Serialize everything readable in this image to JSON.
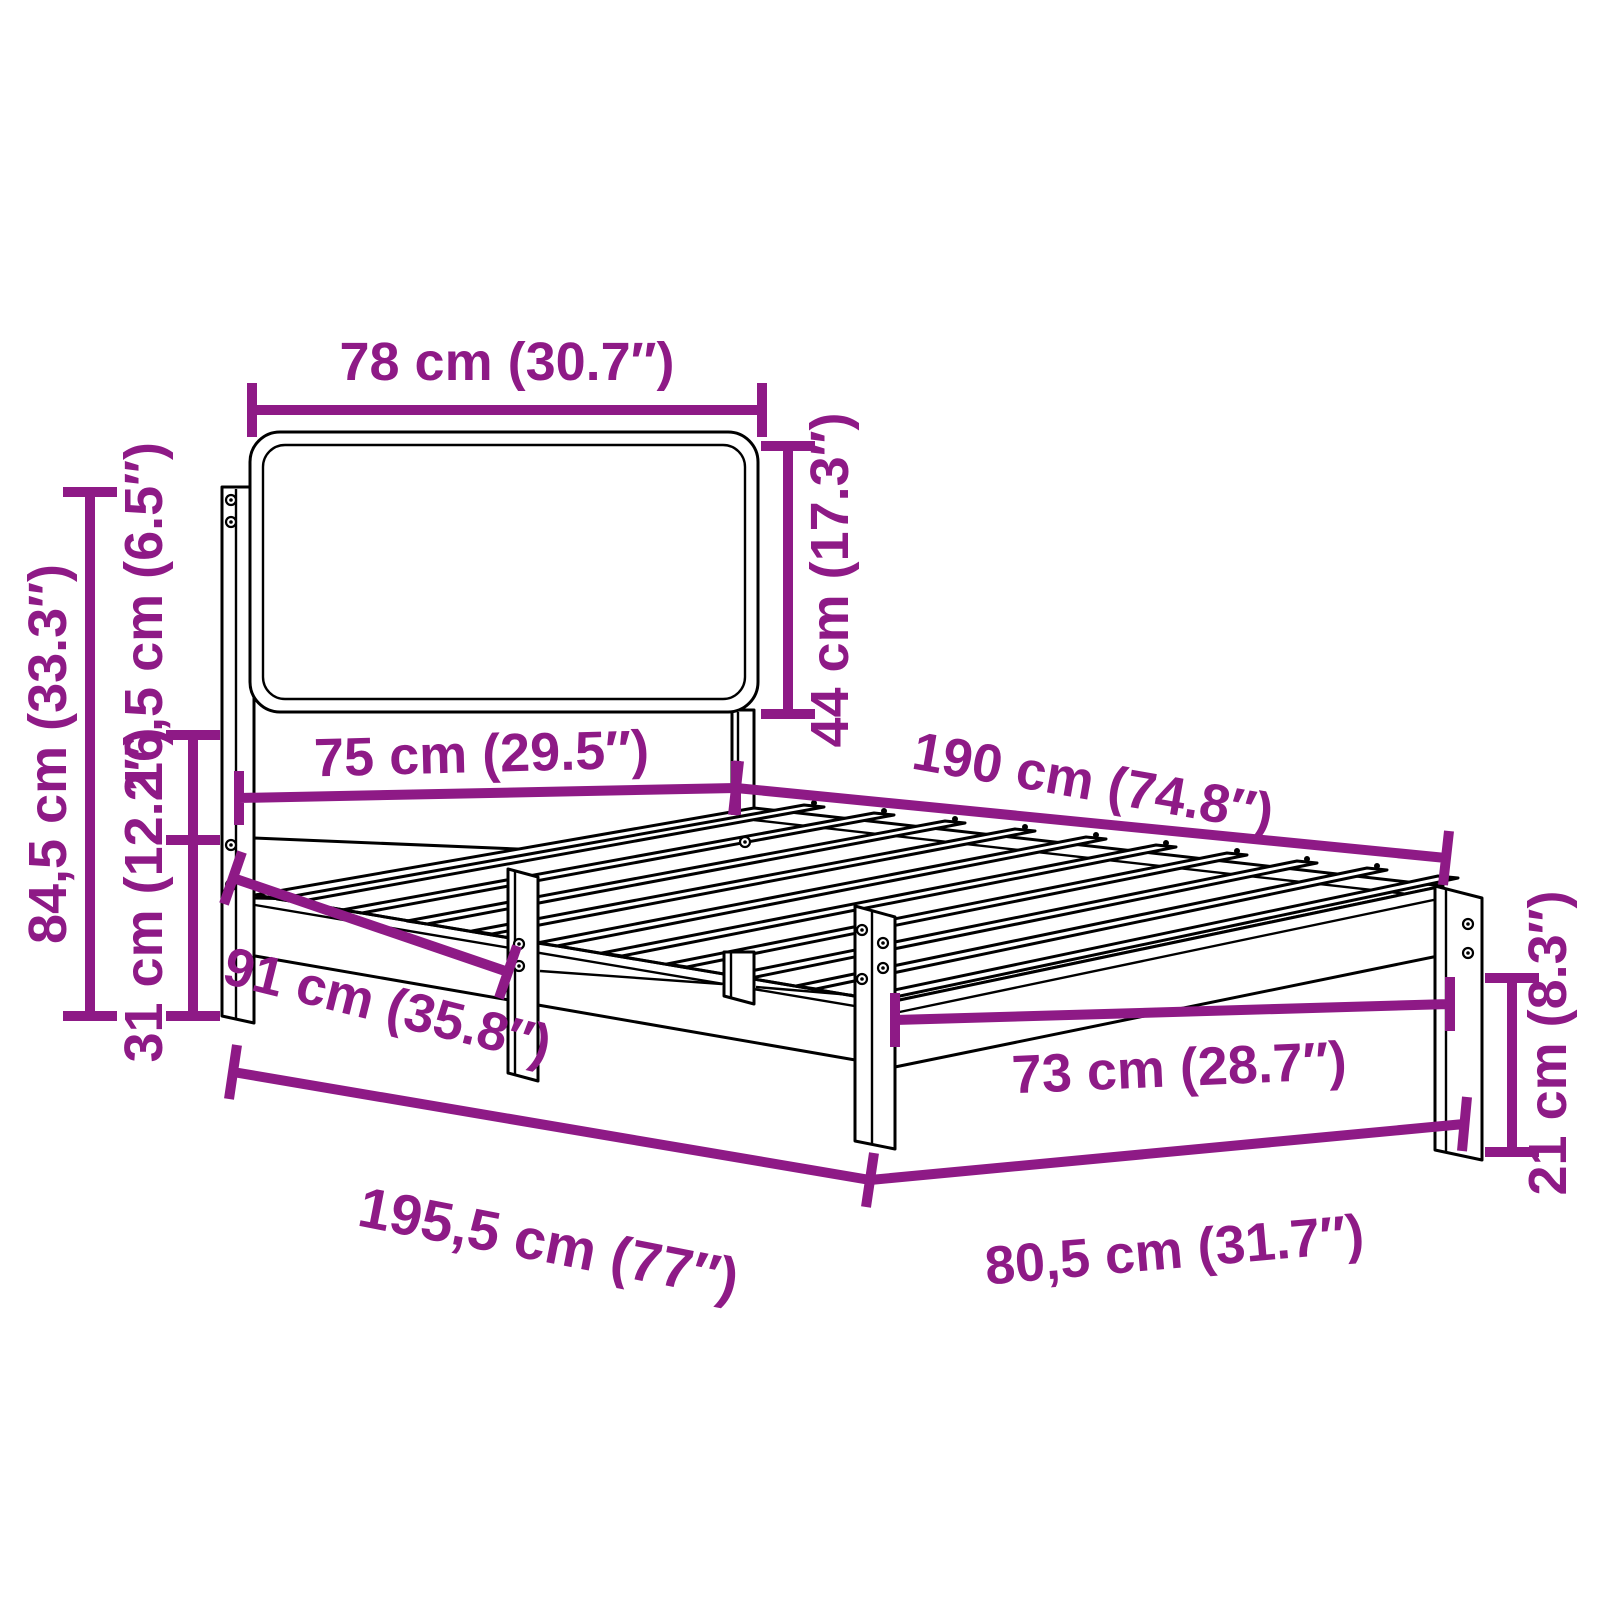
{
  "figure": {
    "type": "furniture-dimension-diagram",
    "subject": "bed frame with upholstered headboard, slatted base and four legs",
    "view": "three-quarter perspective line drawing",
    "units": [
      "cm",
      "inch"
    ],
    "accent_color": "#8E1A86",
    "line_color": "#000000",
    "background_color": "#FFFFFF"
  },
  "dimensions": {
    "headboard_width": "78 cm (30.7″)",
    "headboard_panel_height": "44 cm (17.3″)",
    "headboard_inner_width": "75 cm (29.5″)",
    "frame_length": "190 cm (74.8″)",
    "overall_height": "84,5 cm (33.3″)",
    "headboard_rail_gap": "16,5 cm (6.5″)",
    "base_height": "31 cm (12.2″)",
    "post_to_front_leg": "91 cm (35.8″)",
    "overall_length": "195,5 cm (77″)",
    "foot_inner_width": "73 cm (28.7″)",
    "foot_leg_height": "21 cm (8.3″)",
    "foot_overall_width": "80,5 cm (31.7″)"
  }
}
